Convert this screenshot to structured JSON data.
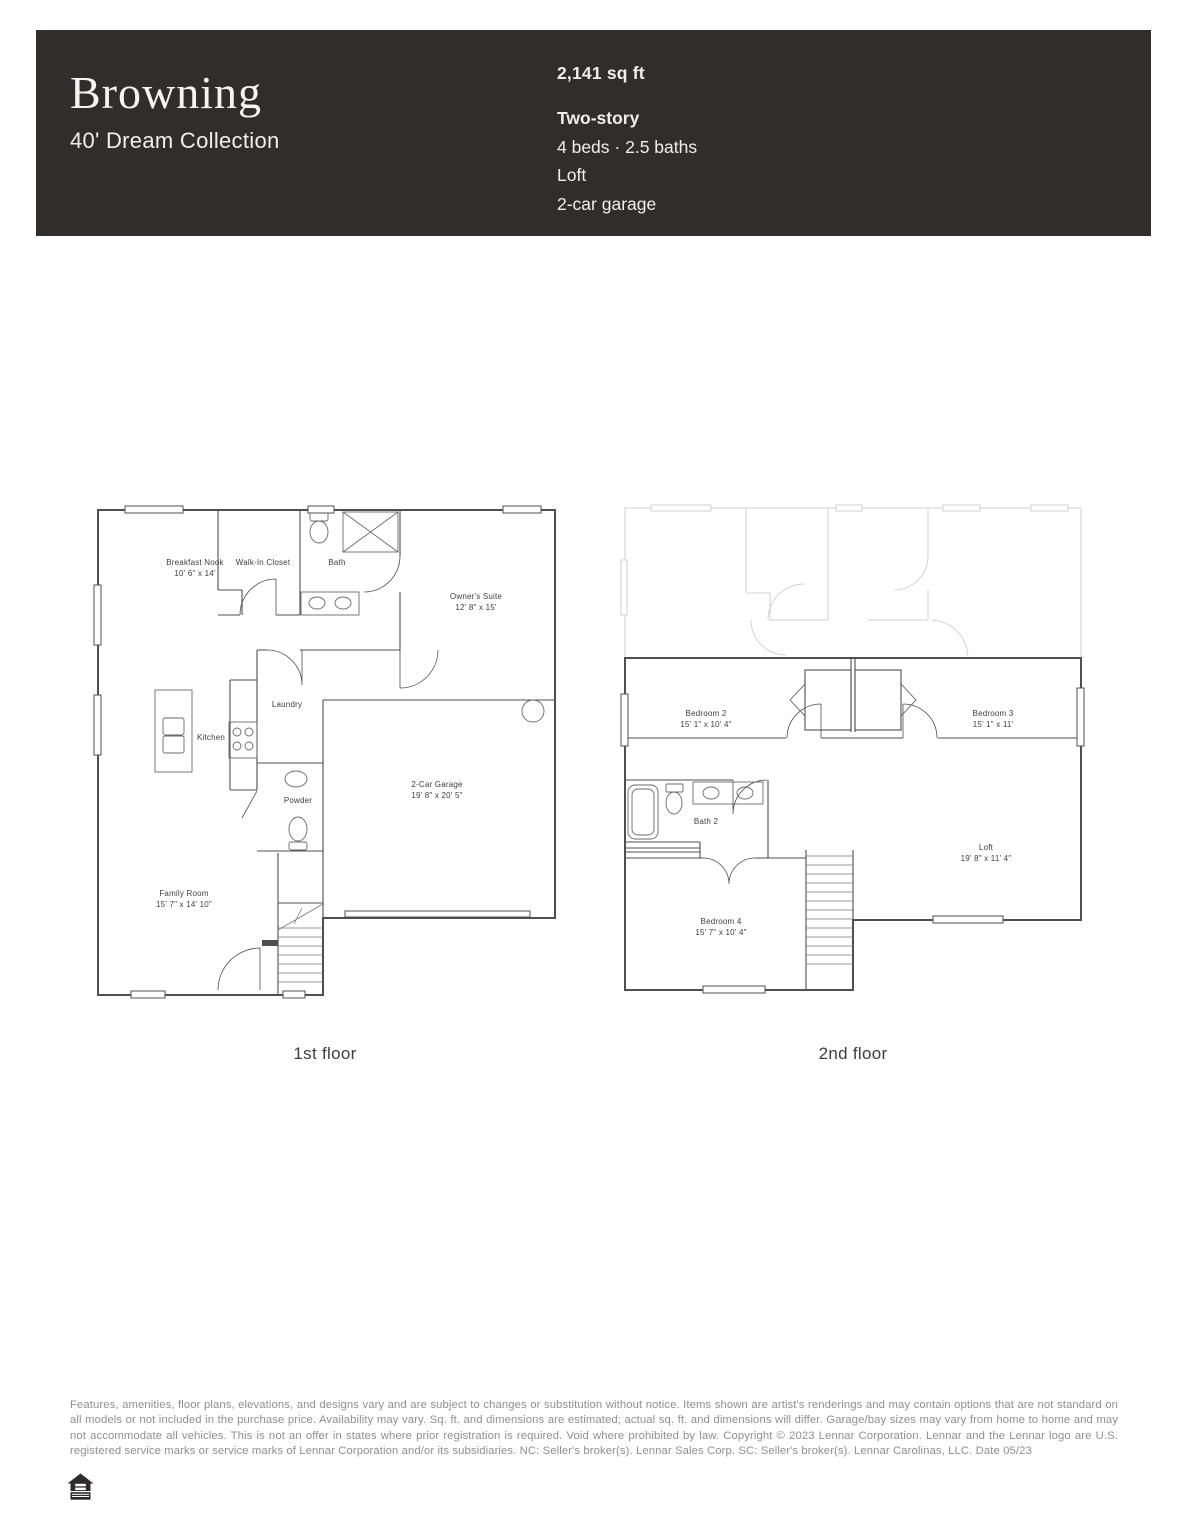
{
  "header": {
    "title": "Browning",
    "collection": "40' Dream Collection",
    "sqft": "2,141 sq ft",
    "stories": "Two-story",
    "beds_baths": "4 beds · 2.5 baths",
    "loft": "Loft",
    "garage": "2-car garage",
    "background_color": "#302d2c"
  },
  "floor1": {
    "caption": "1st floor",
    "rooms": {
      "breakfast_nook": {
        "name": "Breakfast Nook",
        "dims": "10' 6\" x 14'"
      },
      "walk_in_closet": {
        "name": "Walk-In Closet"
      },
      "bath": {
        "name": "Bath"
      },
      "owners_suite": {
        "name": "Owner's Suite",
        "dims": "12' 8\" x 15'"
      },
      "laundry": {
        "name": "Laundry"
      },
      "kitchen": {
        "name": "Kitchen"
      },
      "powder": {
        "name": "Powder"
      },
      "garage": {
        "name": "2-Car Garage",
        "dims": "19' 8\" x 20' 5\""
      },
      "family_room": {
        "name": "Family Room",
        "dims": "15' 7\" x 14' 10\""
      }
    }
  },
  "floor2": {
    "caption": "2nd floor",
    "rooms": {
      "bedroom2": {
        "name": "Bedroom 2",
        "dims": "15' 1\" x 10' 4\""
      },
      "bedroom3": {
        "name": "Bedroom 3",
        "dims": "15' 1\" x 11'"
      },
      "bath2": {
        "name": "Bath 2"
      },
      "loft": {
        "name": "Loft",
        "dims": "19' 8\" x 11' 4\""
      },
      "bedroom4": {
        "name": "Bedroom 4",
        "dims": "15' 7\" x 10' 4\""
      }
    }
  },
  "footer": {
    "disclaimer": "Features, amenities, floor plans, elevations, and designs vary and are subject to changes or substitution without notice. Items shown are artist's renderings and may contain options that are not standard on all models or not included in the purchase price. Availability may vary. Sq. ft. and dimensions are estimated; actual sq. ft. and dimensions will differ. Garage/bay sizes may vary from home to home and may not accommodate all vehicles. This is not an offer in states where prior registration is required. Void where prohibited by law. Copyright © 2023 Lennar Corporation. Lennar and the Lennar logo are U.S. registered service marks or service marks of Lennar Corporation and/or its subsidiaries. NC: Seller's broker(s). Lennar Sales Corp. SC: Seller's broker(s). Lennar Carolinas, LLC. Date 05/23",
    "equal_housing_icon": "equal-housing-opportunity-logo"
  },
  "colors": {
    "wall": "#4f4f4f",
    "ghost": "#d2d2d2",
    "label": "#3e3e3e",
    "disclaimer_text": "#8f8f8f"
  }
}
